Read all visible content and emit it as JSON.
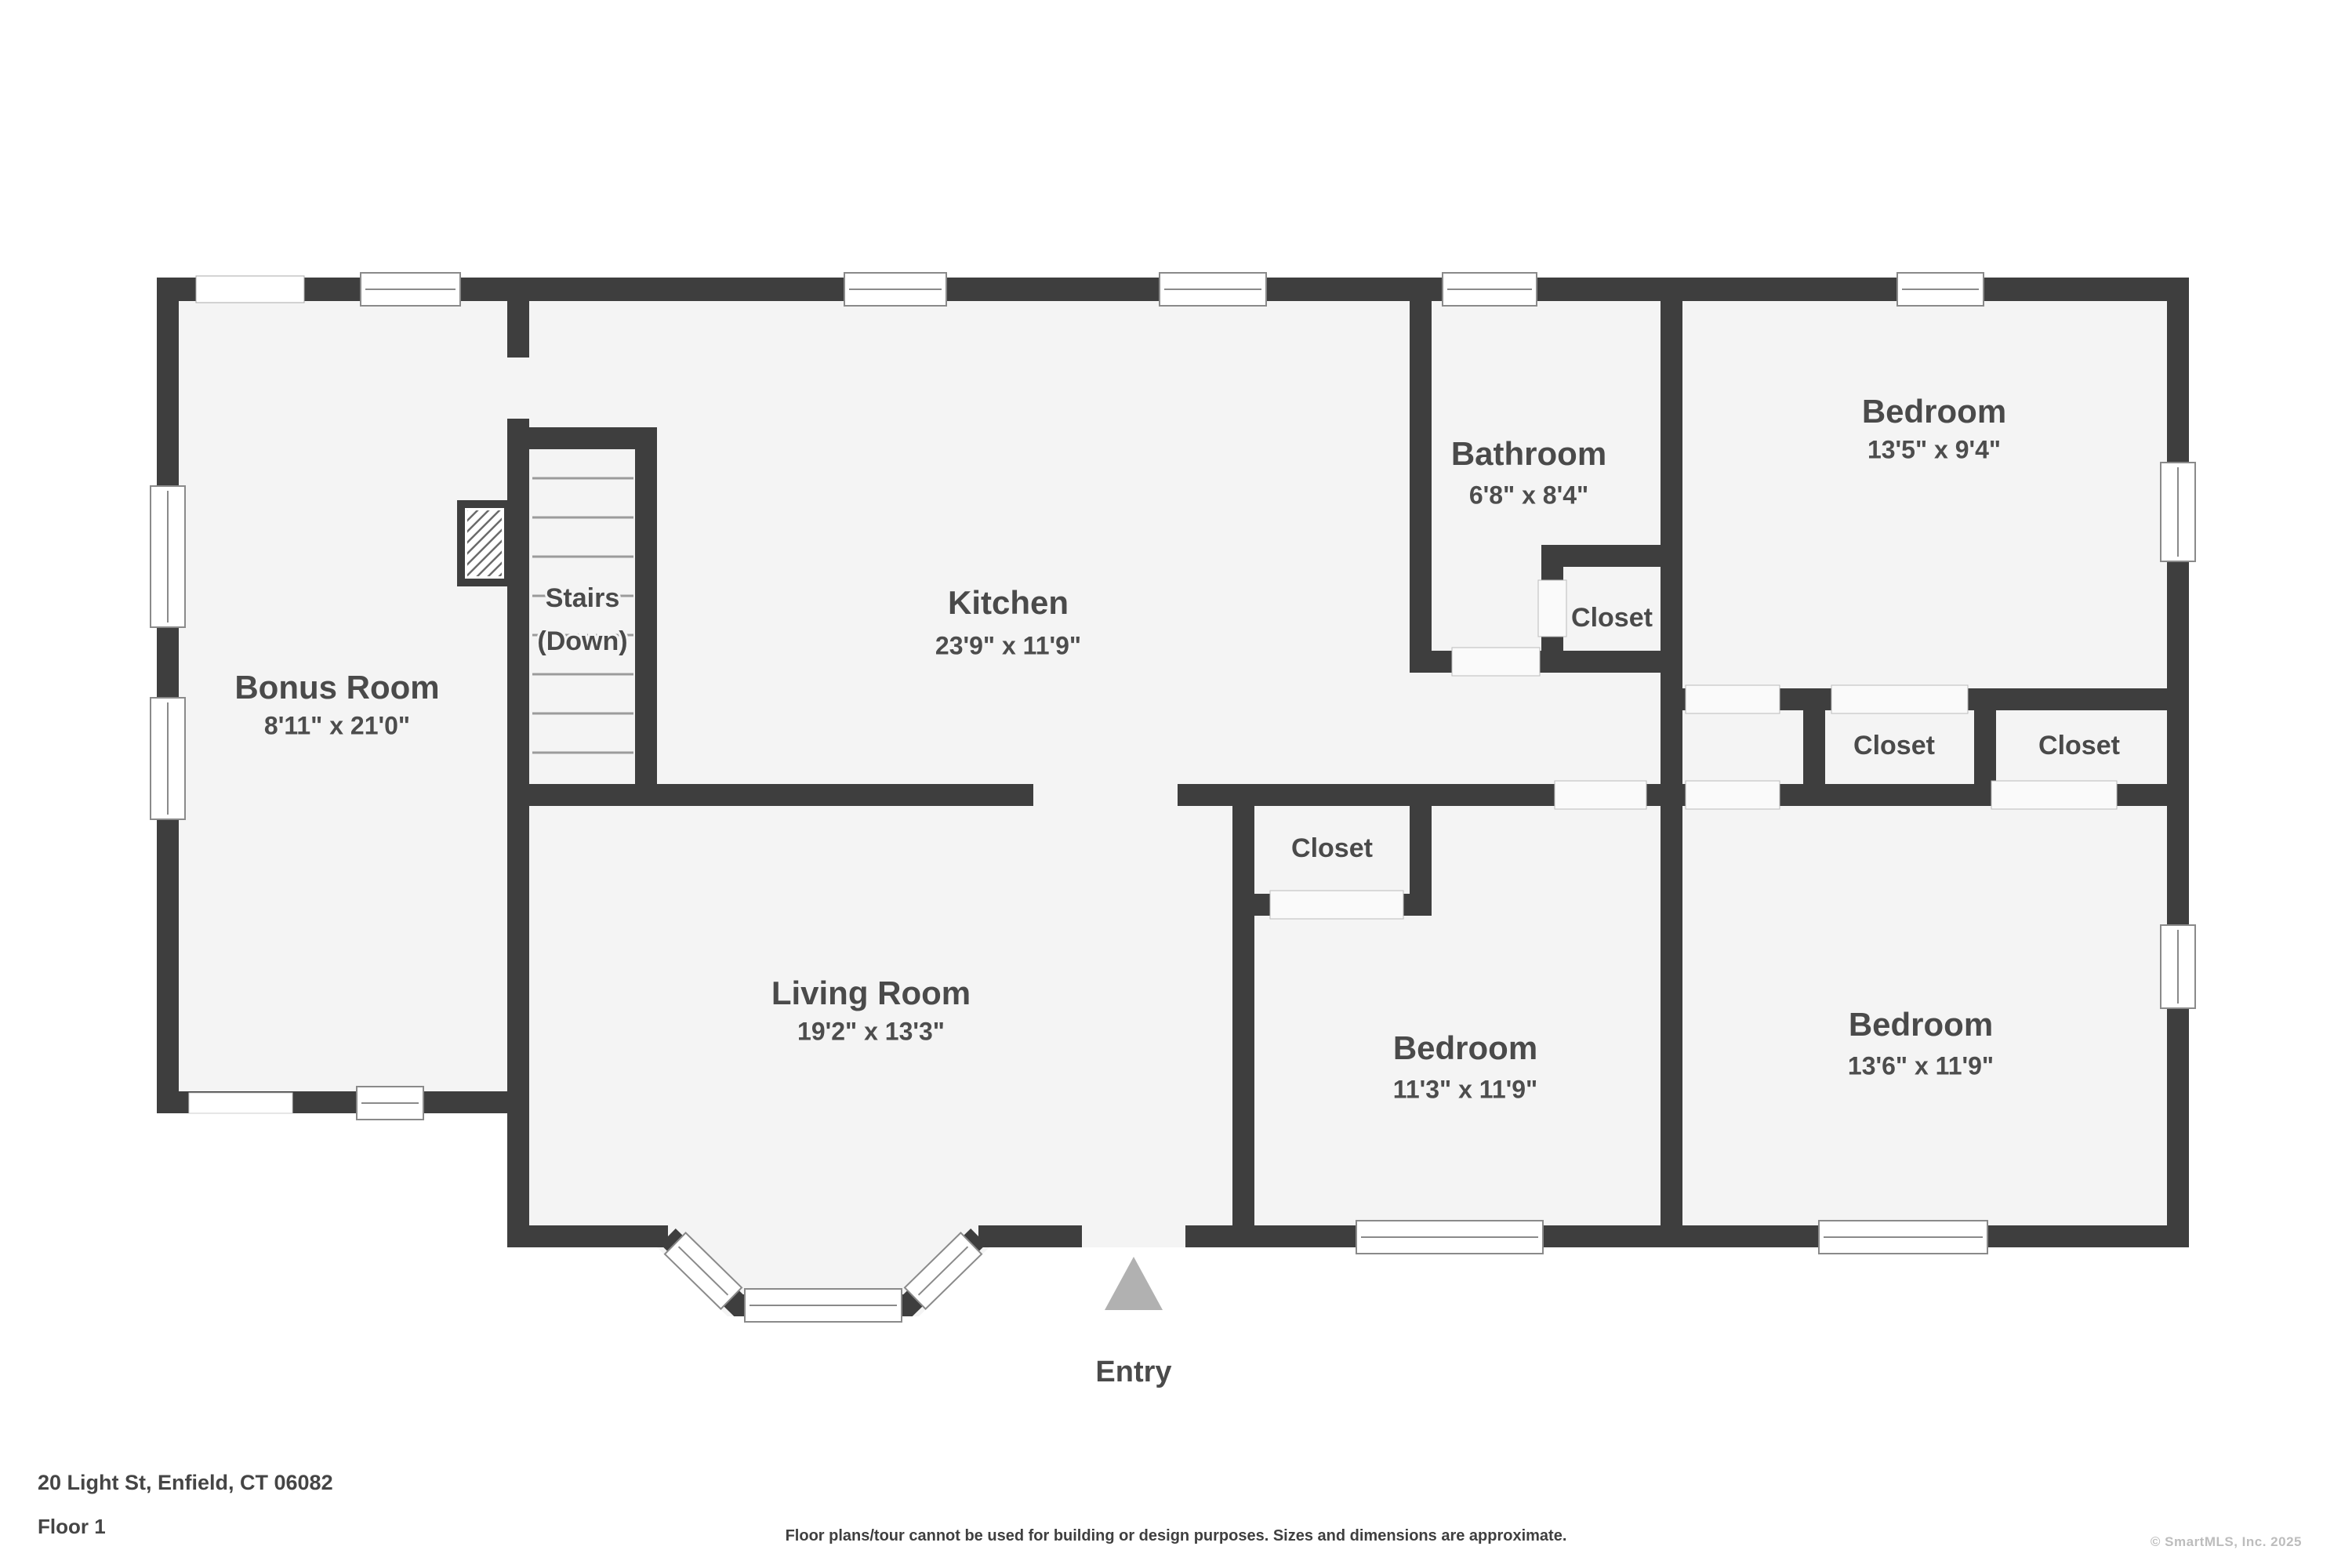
{
  "rooms": {
    "bonus": {
      "name": "Bonus Room",
      "dims": "8'11\" x 21'0\""
    },
    "kitchen": {
      "name": "Kitchen",
      "dims": "23'9\" x 11'9\""
    },
    "bathroom": {
      "name": "Bathroom",
      "dims": "6'8\" x 8'4\""
    },
    "bedroom_top_right": {
      "name": "Bedroom",
      "dims": "13'5\" x 9'4\""
    },
    "living": {
      "name": "Living Room",
      "dims": "19'2\" x 13'3\""
    },
    "bedroom_middle": {
      "name": "Bedroom",
      "dims": "11'3\" x 11'9\""
    },
    "bedroom_bottom_right": {
      "name": "Bedroom",
      "dims": "13'6\" x 11'9\""
    }
  },
  "stairs": {
    "line1": "Stairs",
    "line2": "(Down)"
  },
  "closets": {
    "bathroom": "Closet",
    "upper_left": "Closet",
    "upper_right": "Closet",
    "hall": "Closet"
  },
  "entry": {
    "label": "Entry"
  },
  "footer": {
    "address": "20 Light St, Enfield, CT 06082",
    "floor": "Floor 1",
    "disclaimer": "Floor plans/tour cannot be used for building or design purposes. Sizes and dimensions are approximate.",
    "copyright": "© SmartMLS, Inc. 2025"
  },
  "colors": {
    "wall": "#3e3e3e",
    "floor_fill": "#f4f4f4",
    "label": "#4a4a4a",
    "entry_arrow": "#b1b1b1",
    "copyright_text": "#bdbdbd",
    "tread_line": "#9b9b9b",
    "window_frame": "#8a8a8a"
  }
}
